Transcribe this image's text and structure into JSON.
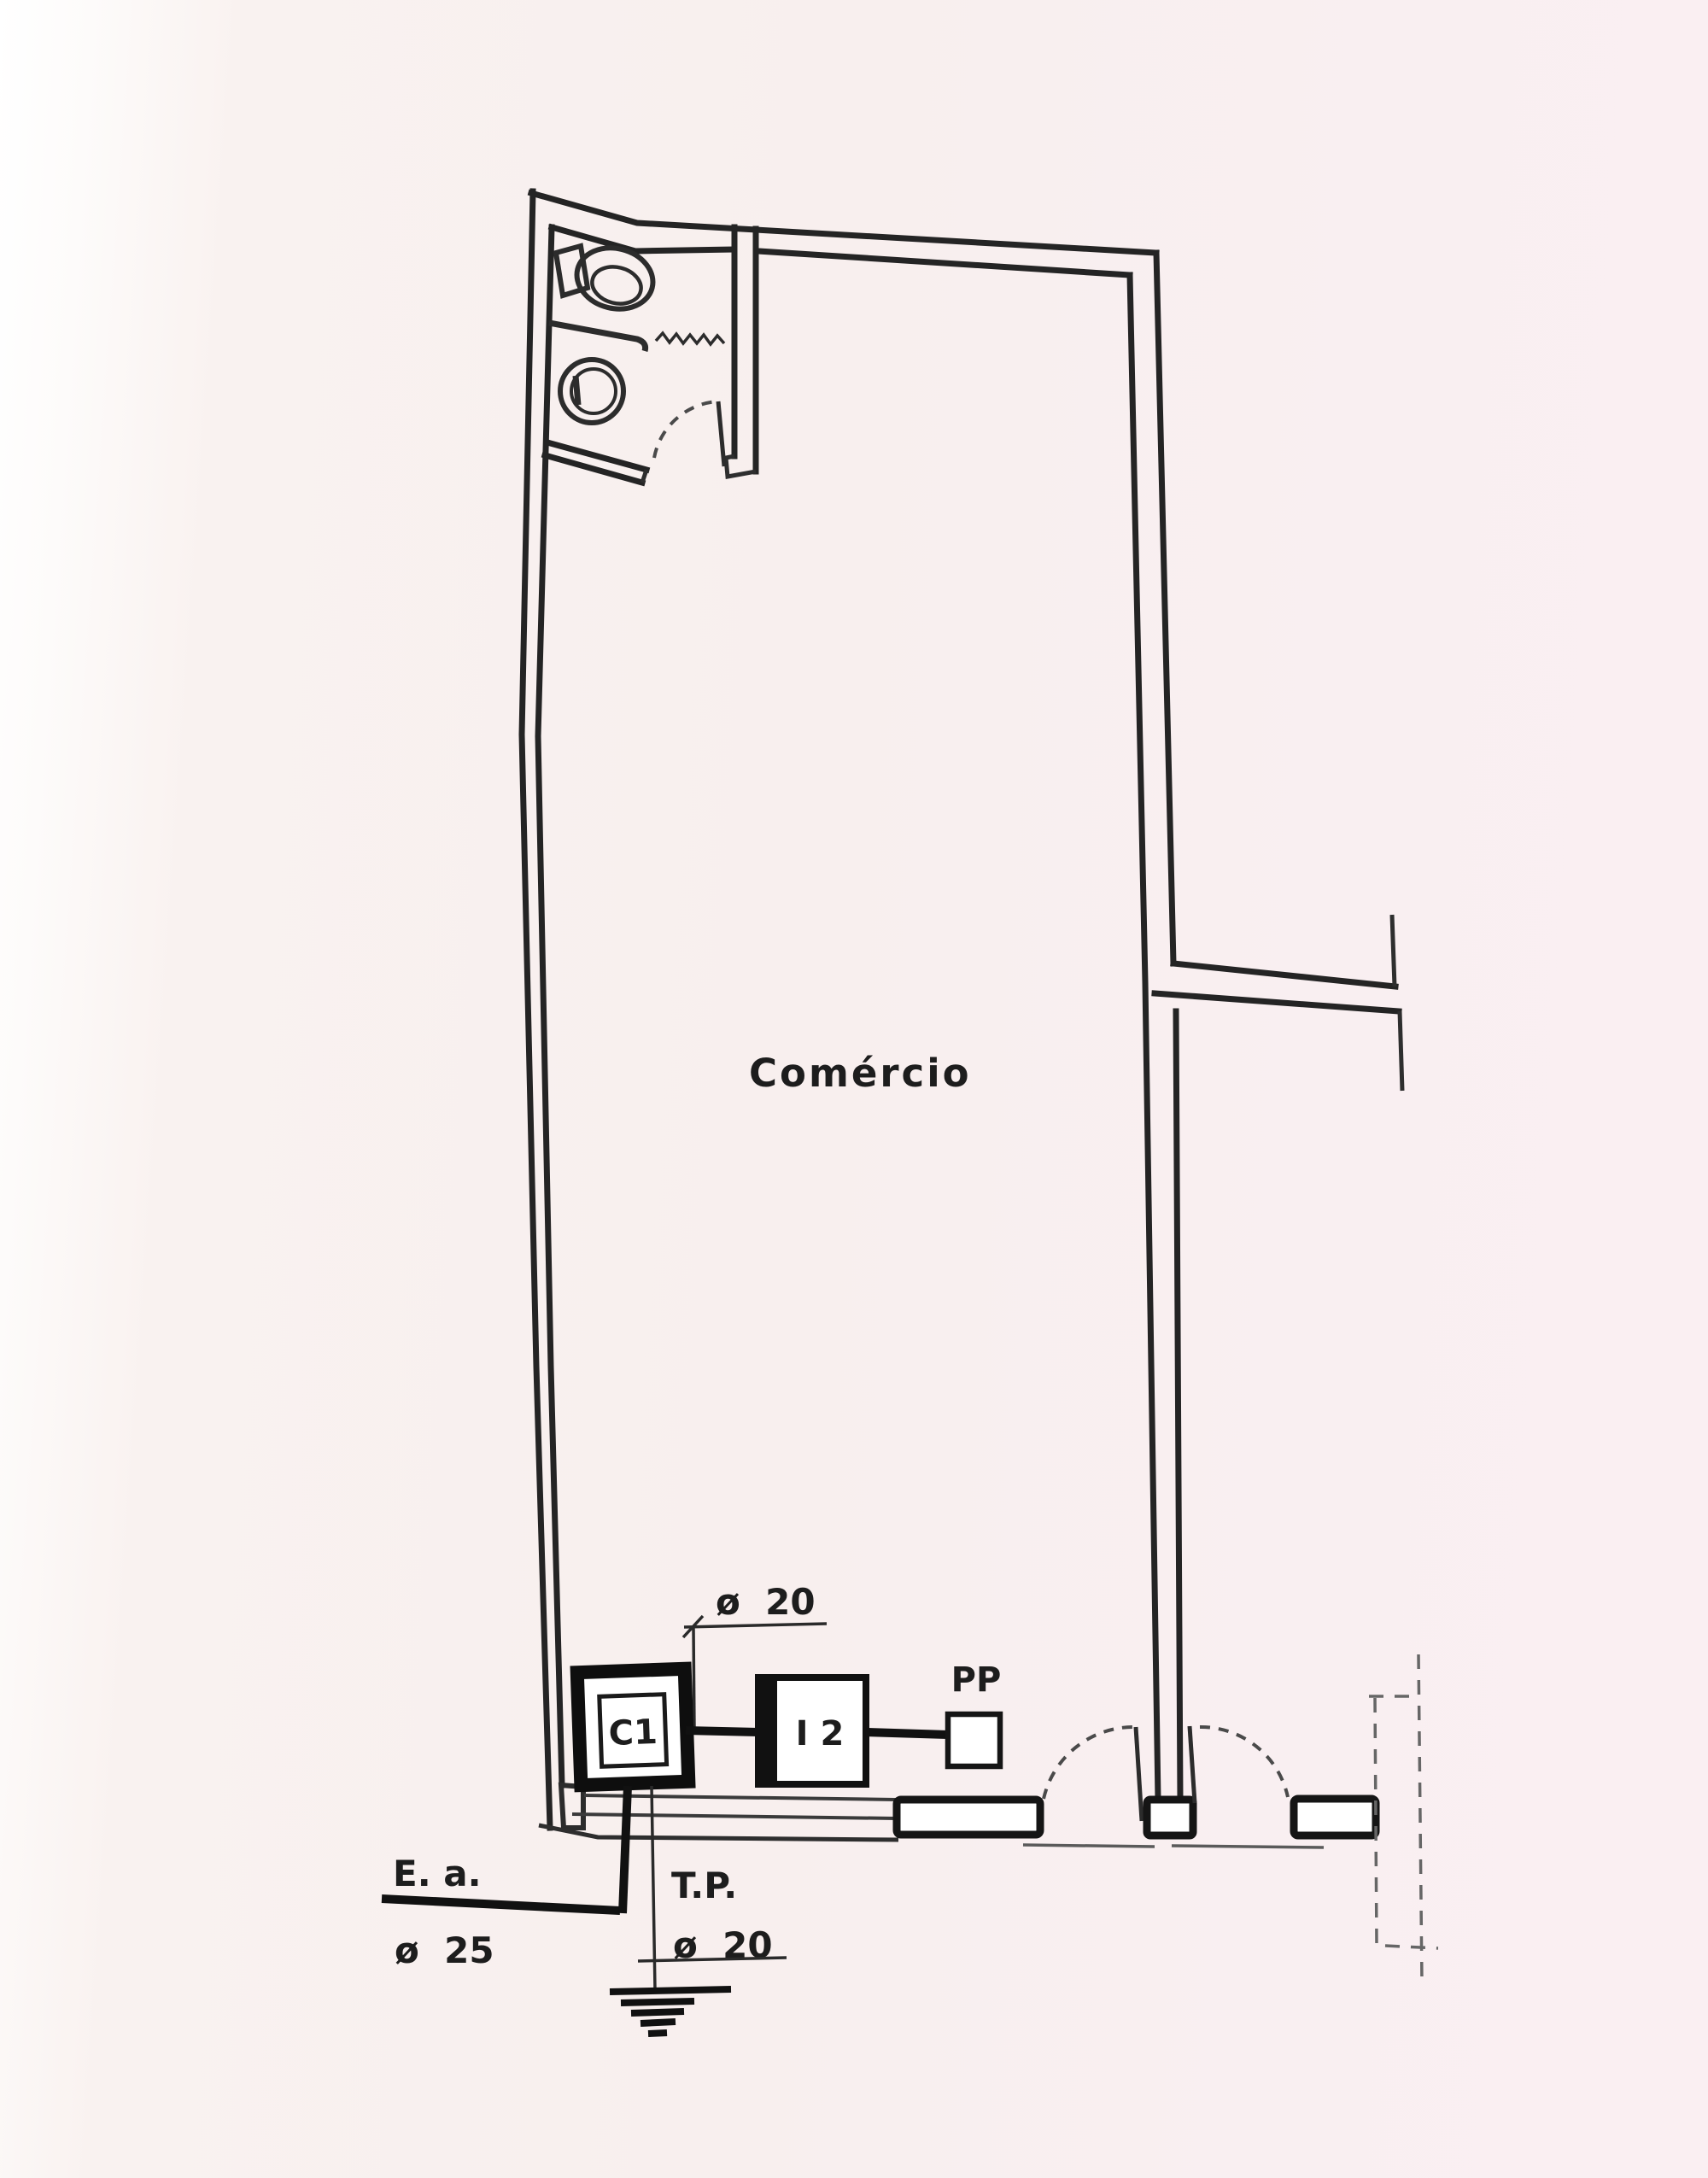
{
  "drawing": {
    "room_label": "Comércio",
    "symbols": {
      "c1": "C1",
      "i2": "I 2",
      "pp_label": "PP"
    },
    "annotations": {
      "conduit_top_diameter": "ø  20",
      "feed_label": "E. a.",
      "feed_diameter": "ø  25",
      "ground_label": "T.P.",
      "ground_diameter": "ø  20"
    },
    "colors": {
      "paper": "#f8efee",
      "ink": "#242424",
      "light_line": "#555555"
    }
  }
}
